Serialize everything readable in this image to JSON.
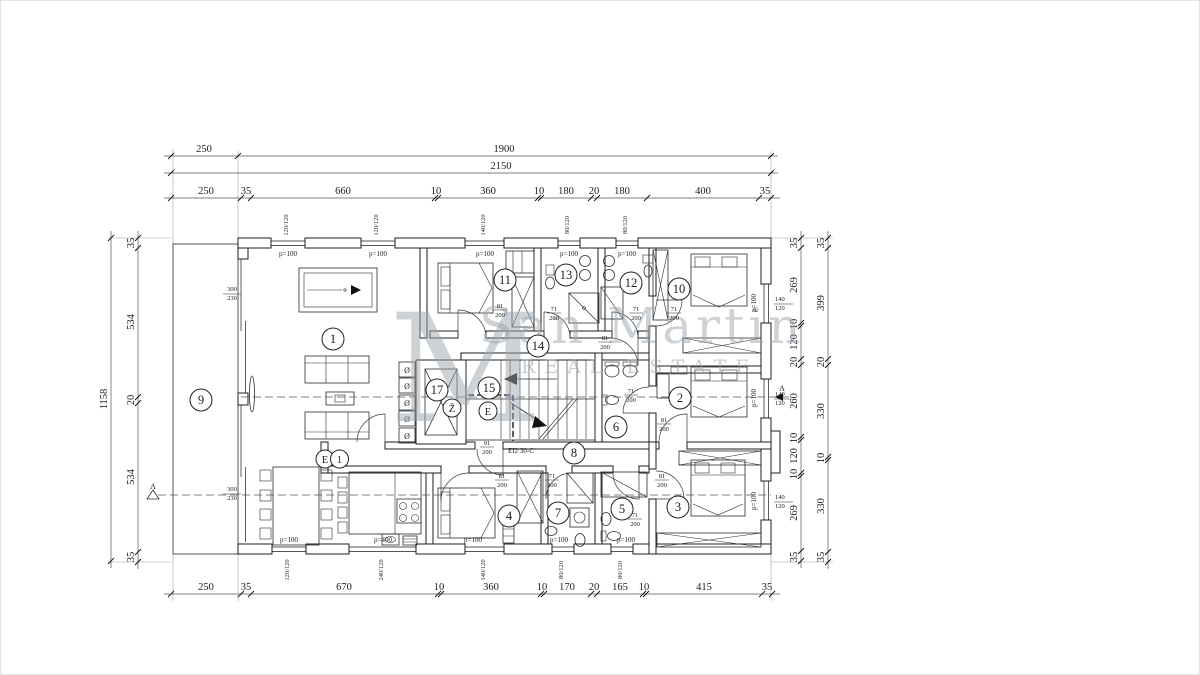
{
  "watermark": {
    "monogram": "M",
    "brand": "San Martin",
    "tagline": "REAL ESTATE"
  },
  "dims": {
    "top1": [
      "250",
      "1900"
    ],
    "top2": [
      "2150"
    ],
    "top3": [
      "250",
      "35",
      "660",
      "10",
      "360",
      "10",
      "180",
      "20",
      "180",
      "400",
      "35"
    ],
    "bottom": [
      "250",
      "35",
      "670",
      "10",
      "360",
      "10",
      "170",
      "20",
      "165",
      "10",
      "415",
      "35"
    ],
    "left_outer": [
      "1158"
    ],
    "left_inner": [
      "35",
      "534",
      "20",
      "534",
      "35"
    ],
    "right_inner": [
      "35",
      "269",
      "10",
      "120",
      "20",
      "260",
      "10",
      "120",
      "10",
      "269",
      "35"
    ],
    "right_outer": [
      "35",
      "399",
      "20",
      "330",
      "10",
      "330",
      "35"
    ]
  },
  "rooms": [
    "1",
    "2",
    "3",
    "4",
    "5",
    "6",
    "7",
    "8",
    "9",
    "10",
    "11",
    "12",
    "13",
    "14",
    "15",
    "17"
  ],
  "markers": {
    "elevator": "Ž",
    "stair_core": "E",
    "unit_entrance": "E",
    "unit_number": "1",
    "section": "A"
  },
  "doors": [
    {
      "w": "81",
      "h": "200"
    },
    {
      "w": "71",
      "h": "200"
    },
    {
      "w": "71",
      "h": "200"
    },
    {
      "w": "81",
      "h": "200"
    },
    {
      "w": "91",
      "h": "200"
    },
    {
      "w": "71",
      "h": "200"
    },
    {
      "w": "81",
      "h": "200"
    },
    {
      "w": "81",
      "h": "200"
    },
    {
      "w": "81",
      "h": "200"
    },
    {
      "w": "71",
      "h": "200"
    },
    {
      "w": "71",
      "h": "200"
    },
    {
      "w": "71",
      "h": "200"
    }
  ],
  "windows": {
    "top": [
      "120/120",
      "120/120",
      "140/120",
      "80/120",
      "80/120"
    ],
    "bottom": [
      "120/120",
      "240/120",
      "140/120",
      "80/120",
      "80/120"
    ],
    "right": [
      {
        "w": "140",
        "h": "120"
      },
      {
        "w": "140",
        "h": "120"
      },
      {
        "w": "140",
        "h": "120"
      }
    ],
    "left": [
      {
        "w": "300",
        "h": "230"
      },
      {
        "w": "300",
        "h": "230"
      }
    ]
  },
  "labels": {
    "parapet": "p=100",
    "parapet_kitchen": "p=400",
    "fire_door": "EI2 30-C"
  }
}
